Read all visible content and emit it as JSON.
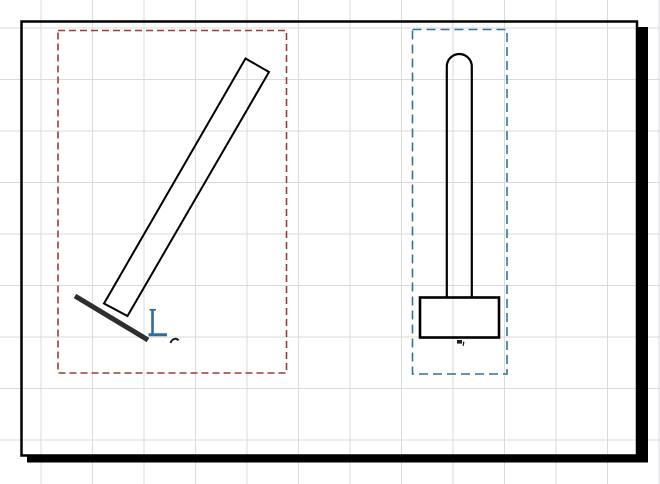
{
  "app": {
    "view_label": "drawing-area"
  },
  "canvas": {
    "width": 660,
    "height": 484,
    "background": "#ffffff",
    "grid": {
      "spacing": 51.5,
      "offset_x": 40.5,
      "offset_y": 27.5,
      "color": "#d9dadc"
    }
  },
  "colors": {
    "sheet_border": "#000000",
    "sheet_shadow": "#000000",
    "left_selection_box": "#9c3b38",
    "right_selection_box": "#2e7693",
    "datum_marker": "#2e6da4",
    "geometry_line": "#000000",
    "ground_line": "#2e2e2e",
    "cursor_mark": "#1f1f1f"
  },
  "drawing": {
    "elements": [
      {
        "tag": "rect",
        "name": "sheet-border",
        "interactable": false,
        "attrs": {
          "x": 21.5,
          "y": 21.5,
          "width": 615.5,
          "height": 434,
          "fill": "none",
          "stroke": "#000000",
          "stroke-width": 2.5
        }
      },
      {
        "tag": "rect",
        "name": "sheet-shadow-right",
        "interactable": false,
        "attrs": {
          "x": 637.5,
          "y": 27,
          "width": 10.5,
          "height": 435.5,
          "fill": "#000000",
          "stroke": "none"
        }
      },
      {
        "tag": "rect",
        "name": "sheet-shadow-bottom",
        "interactable": false,
        "attrs": {
          "x": 27,
          "y": 455,
          "width": 621,
          "height": 7.5,
          "fill": "#000000",
          "stroke": "none"
        }
      },
      {
        "tag": "rect",
        "name": "left-selection-box",
        "interactable": true,
        "attrs": {
          "x": 58,
          "y": 30.5,
          "width": 228.5,
          "height": 342.5,
          "fill": "none",
          "stroke": "#9c3b38",
          "stroke-width": 1.6,
          "stroke-dasharray": "7 4"
        }
      },
      {
        "tag": "rect",
        "name": "right-selection-box",
        "interactable": true,
        "attrs": {
          "x": 412.5,
          "y": 29.5,
          "width": 94.5,
          "height": 344.5,
          "fill": "none",
          "stroke": "#2e7693",
          "stroke-width": 1.6,
          "stroke-dasharray": "9 5"
        }
      },
      {
        "tag": "polygon",
        "name": "tilted-bar-extrusion",
        "interactable": true,
        "attrs": {
          "points": "245.5,58.5 269,72 127.5,316 104,303.5",
          "fill": "none",
          "stroke": "#000000",
          "stroke-width": 2,
          "stroke-linejoin": "miter"
        }
      },
      {
        "tag": "line",
        "name": "ground-reference-line",
        "interactable": true,
        "attrs": {
          "x1": 75,
          "y1": 296,
          "x2": 148,
          "y2": 340,
          "stroke": "#2e2e2e",
          "stroke-width": 5
        }
      },
      {
        "tag": "line",
        "name": "datum-marker-vertical",
        "interactable": true,
        "attrs": {
          "x1": 152.5,
          "y1": 309.5,
          "x2": 152.5,
          "y2": 334.8,
          "stroke": "#2e6da4",
          "stroke-width": 2.6
        }
      },
      {
        "tag": "line",
        "name": "datum-marker-horizontal",
        "interactable": true,
        "attrs": {
          "x1": 148.5,
          "y1": 334.8,
          "x2": 167,
          "y2": 334.8,
          "stroke": "#2e6da4",
          "stroke-width": 3
        }
      },
      {
        "tag": "line",
        "name": "datum-marker-top-tick",
        "interactable": false,
        "attrs": {
          "x1": 149.5,
          "y1": 309.8,
          "x2": 156,
          "y2": 309.8,
          "stroke": "#2e6da4",
          "stroke-width": 1.8
        }
      },
      {
        "tag": "path",
        "name": "cursor-mark-left",
        "interactable": false,
        "attrs": {
          "d": "M170.5 343 C172 338.5 176.5 337.5 178.5 340.5",
          "fill": "none",
          "stroke": "#1f1f1f",
          "stroke-width": 2
        }
      },
      {
        "tag": "path",
        "name": "column-extrusion",
        "interactable": true,
        "attrs": {
          "d": "M446.8 298 L446.8 66.5 A12.5 12.5 0 0 1 471.8 66.5 L471.8 298",
          "fill": "none",
          "stroke": "#000000",
          "stroke-width": 2.2
        }
      },
      {
        "tag": "rect",
        "name": "footing-extrusion",
        "interactable": true,
        "attrs": {
          "x": 420,
          "y": 297.5,
          "width": 79,
          "height": 40,
          "fill": "none",
          "stroke": "#000000",
          "stroke-width": 2.6
        }
      },
      {
        "tag": "rect",
        "name": "insertion-mark-right-square",
        "interactable": false,
        "attrs": {
          "x": 457,
          "y": 340,
          "width": 5,
          "height": 3.6,
          "fill": "#1f1f1f",
          "stroke": "none"
        }
      },
      {
        "tag": "line",
        "name": "insertion-mark-right-tail",
        "interactable": false,
        "attrs": {
          "x1": 463.8,
          "y1": 341.5,
          "x2": 463.2,
          "y2": 345.8,
          "stroke": "#1f1f1f",
          "stroke-width": 1.3
        }
      }
    ]
  }
}
